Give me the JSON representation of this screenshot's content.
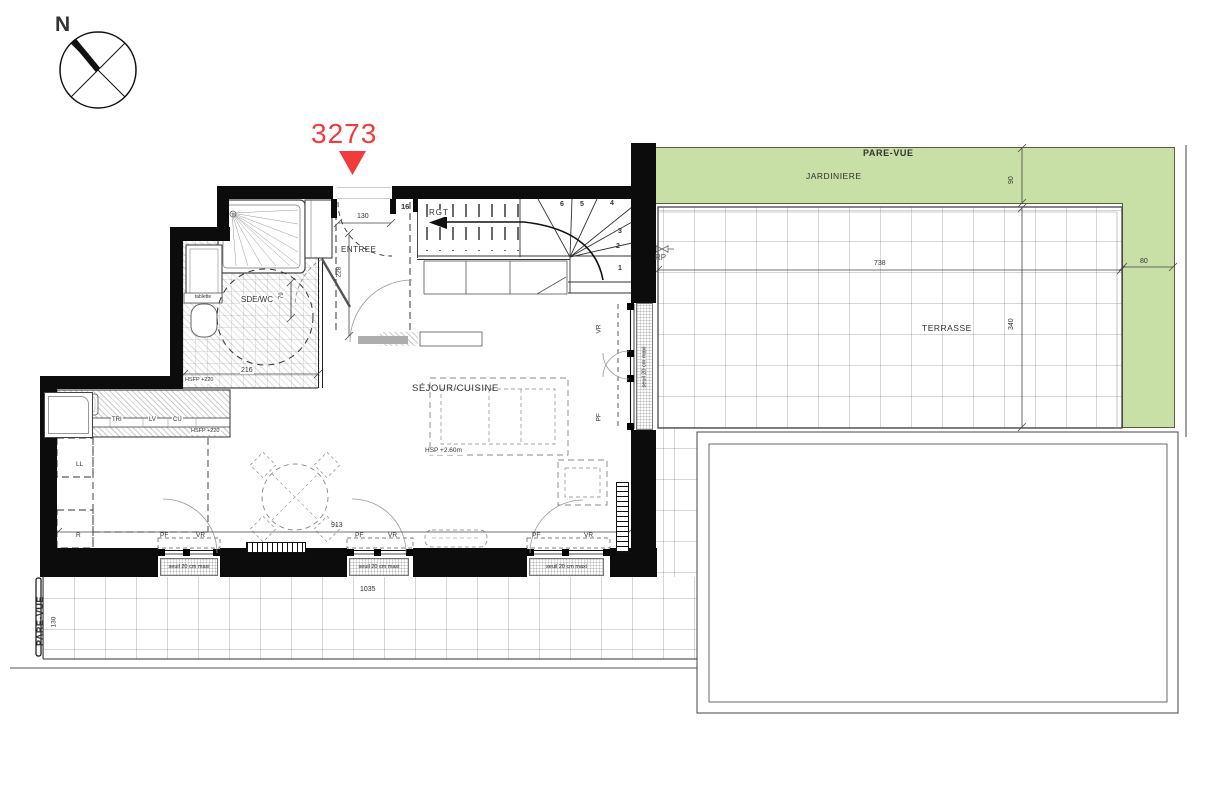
{
  "colors": {
    "accent_red": "#f23b3b",
    "jardiniere_green": "#c8dfa5",
    "wall_black": "#0c0c0c"
  },
  "compass": {
    "north_label": "N"
  },
  "unit": {
    "number": "3273"
  },
  "rooms": {
    "entree": "ENTREE",
    "sde_wc": "SDE/WC",
    "rgt": "RGT",
    "sejour_cuisine": "SÉJOUR/CUISINE",
    "terrasse": "TERRASSE",
    "jardiniere": "JARDINIERE"
  },
  "labels": {
    "pare_vue_top": "PARE-VUE",
    "pare_vue_left": "PARE-VUE",
    "tablette": "tablette",
    "tri": "TRI",
    "lv": "LV",
    "cu": "CU",
    "ll": "LL",
    "r": "R",
    "rp": "RP",
    "hsfp_sde": "HSFP +220",
    "hsfp_cuisine": "HSFP +220",
    "hsp": "HSP +2.60m",
    "steps_count": "16"
  },
  "stairs": {
    "numbers": [
      "1",
      "2",
      "3",
      "4",
      "5",
      "6"
    ]
  },
  "windows": [
    {
      "id": "south-1",
      "pf": "PF",
      "vr": "VR",
      "seuil": "seuil 20 cm maxi"
    },
    {
      "id": "south-2",
      "pf": "PF",
      "vr": "VR",
      "seuil": "seuil 20 cm maxi"
    },
    {
      "id": "south-3",
      "pf": "PF",
      "vr": "VR",
      "seuil": "seuil 20 cm maxi"
    },
    {
      "id": "east",
      "pf": "PF",
      "vr": "VR",
      "seuil": "seuil 20 cm maxi"
    }
  ],
  "dimensions": {
    "entry_width": "130",
    "entry_depth": "228",
    "sde_width": "216",
    "sde_door": "79",
    "sejour_width": "913",
    "terrace_south_width": "1035",
    "terrace_east_width": "738",
    "terrace_east_depth": "340",
    "jardiniere_top": "90",
    "jardiniere_right": "80",
    "terrace_south_depth": "130"
  }
}
